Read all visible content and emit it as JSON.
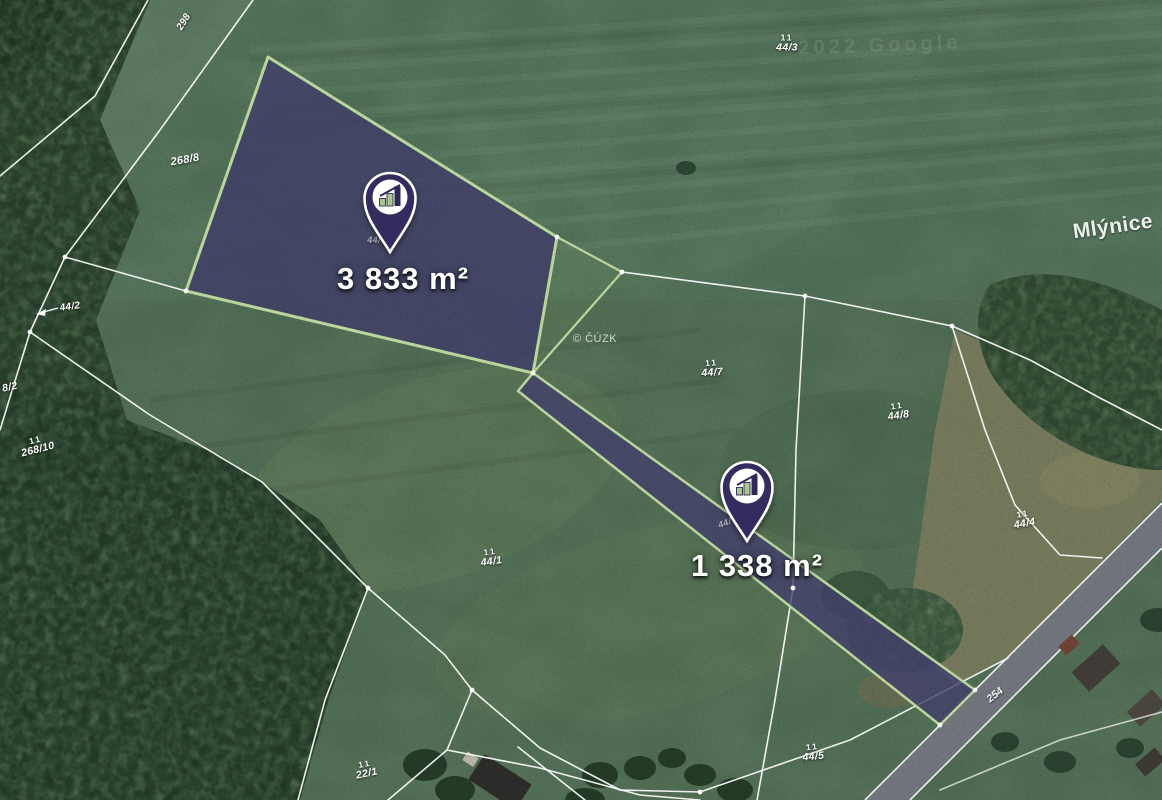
{
  "map": {
    "place_label": "Mlýnice",
    "attribution": "© ČÚZK",
    "watermark": "2022 Google",
    "road_label": "254",
    "landuse_mark": "11",
    "colors": {
      "highlight_fill": "#403d68",
      "highlight_border": "#bcd79e",
      "pin_body": "#342c5e",
      "pin_bar_green": "#a9c789",
      "parcel_line": "#ffffff"
    },
    "parcel_labels": [
      {
        "text": "298",
        "x": 184,
        "y": 22,
        "rot": -58,
        "size": 10
      },
      {
        "text": "268/8",
        "x": 185,
        "y": 160,
        "rot": -10,
        "size": 11
      },
      {
        "text": "44/2",
        "x": 70,
        "y": 307,
        "rot": -8,
        "size": 10
      },
      {
        "text": "8/2",
        "x": 10,
        "y": 388,
        "rot": -12,
        "size": 10.5
      },
      {
        "text": "268/10",
        "x": 37,
        "y": 446,
        "rot": -14,
        "size": 10.5,
        "marks": true
      },
      {
        "text": "44/3",
        "x": 787,
        "y": 44,
        "rot": 0,
        "size": 10.5,
        "marks": true
      },
      {
        "text": "44/7",
        "x": 712,
        "y": 369,
        "rot": -4,
        "size": 10.5,
        "marks": true
      },
      {
        "text": "44/8",
        "x": 898,
        "y": 412,
        "rot": -8,
        "size": 10.5,
        "marks": true
      },
      {
        "text": "44/1",
        "x": 491,
        "y": 558,
        "rot": -8,
        "size": 10.5,
        "marks": true
      },
      {
        "text": "44/4",
        "x": 1024,
        "y": 520,
        "rot": -10,
        "size": 10.5,
        "marks": true
      },
      {
        "text": "22/1",
        "x": 366,
        "y": 770,
        "rot": -12,
        "size": 10.5,
        "marks": true
      },
      {
        "text": "44/5",
        "x": 813,
        "y": 753,
        "rot": -6,
        "size": 10.5,
        "marks": true
      },
      {
        "text": "44/",
        "x": 374,
        "y": 241,
        "rot": 0,
        "size": 9,
        "faded": true
      },
      {
        "text": "44/",
        "x": 725,
        "y": 524,
        "rot": -20,
        "size": 9,
        "faded": true
      }
    ]
  },
  "pins": [
    {
      "name": "pin-parcel-3833",
      "area_label": "3 833 m²",
      "tip_x": 390,
      "tip_y": 253,
      "label_x": 403,
      "label_y": 279
    },
    {
      "name": "pin-parcel-1338",
      "area_label": "1 338 m²",
      "tip_x": 747,
      "tip_y": 542,
      "label_x": 757,
      "label_y": 566
    }
  ]
}
